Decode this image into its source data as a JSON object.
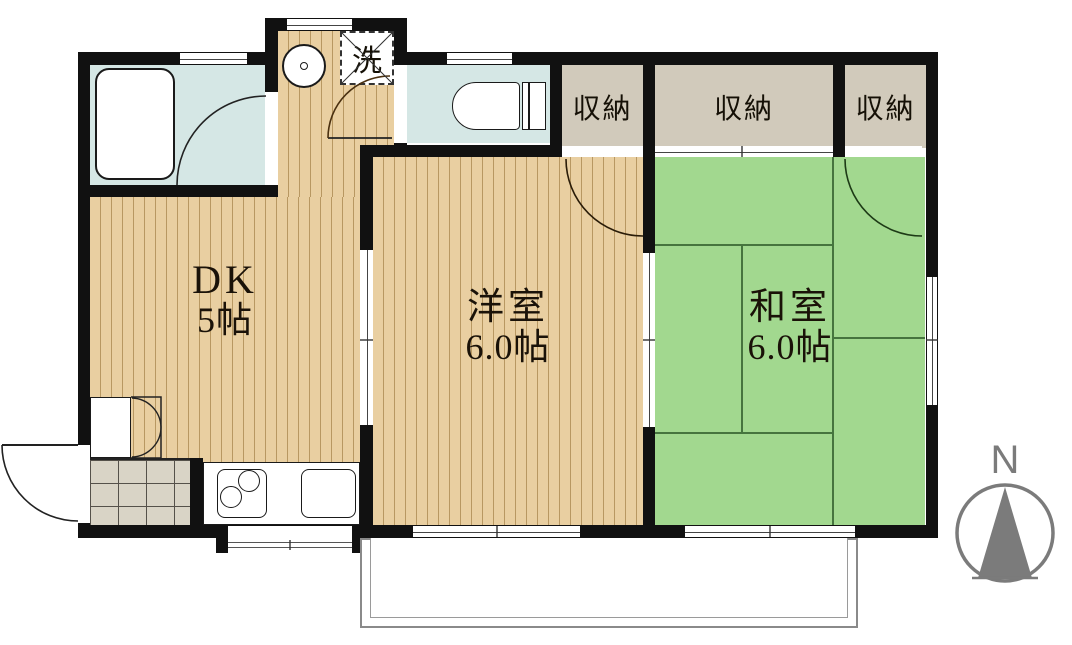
{
  "plan": {
    "title": "apartment-floor-plan",
    "rooms": {
      "dk": {
        "name": "DK",
        "size": "5帖"
      },
      "western": {
        "name": "洋室",
        "size": "6.0帖"
      },
      "japanese": {
        "name": "和室",
        "size": "6.0帖"
      }
    },
    "closets": {
      "c1": "収納",
      "c2": "収納",
      "c3": "収納"
    },
    "laundry": "洗",
    "compass_n": "N",
    "colors": {
      "wall": "#111111",
      "wood_floor": "#e9cfa1",
      "wood_stripe": "#b89862",
      "tatami": "#a2d88f",
      "tatami_line": "#46743e",
      "closet_fill": "#d1cabb",
      "water_room": "#d5e7e5",
      "entry_tile": "#d9d4c6",
      "compass_gray": "#7b7b7b"
    }
  }
}
